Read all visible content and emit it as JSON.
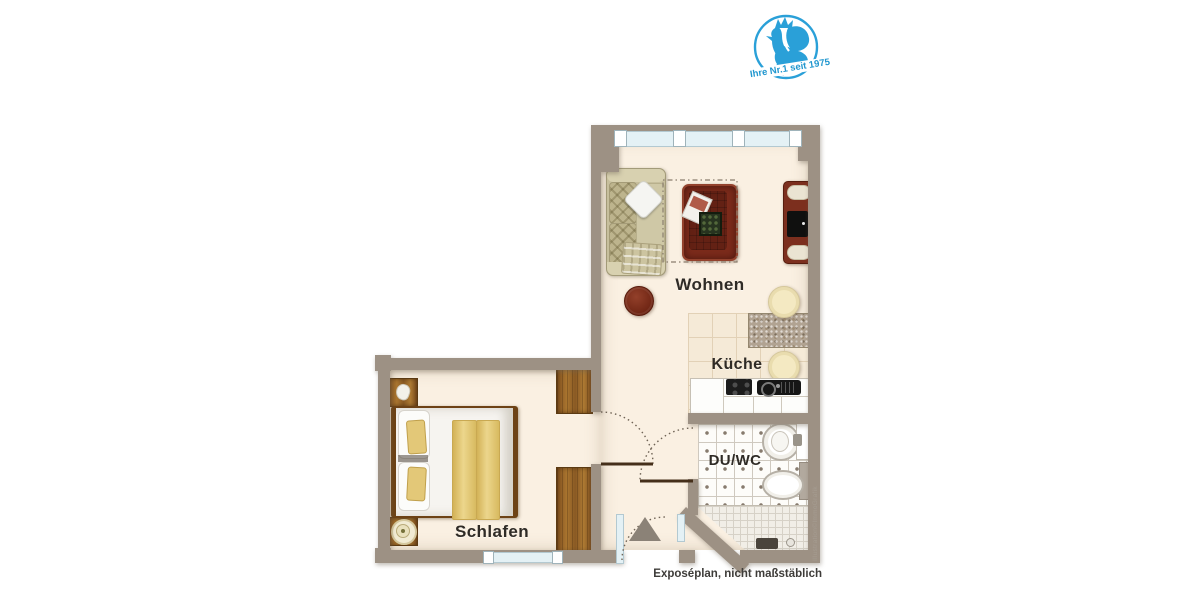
{
  "logo": {
    "icon": "rooster-icon",
    "tagline": "Ihre Nr.1 seit 1975",
    "color": "#2aa0d8"
  },
  "plan": {
    "rooms": [
      {
        "key": "wohnen",
        "label": "Wohnen"
      },
      {
        "key": "kueche",
        "label": "Küche"
      },
      {
        "key": "du_wc",
        "label": "DU/WC"
      },
      {
        "key": "schlafen",
        "label": "Schlafen"
      }
    ],
    "disclaimer": "Exposéplan, nicht maßstäblich",
    "credit": "Illustration©ImmoGrafik",
    "colors": {
      "wall": "#9d9184",
      "floor": "#faf0e2",
      "kitchen_tile": "#f5ead7",
      "bath_tile": "#fdfcf9",
      "wood": "#96642d",
      "furniture_red": "#7c2b1b",
      "window_glass": "#e4f1f5",
      "logo_blue": "#2aa0d8"
    }
  }
}
